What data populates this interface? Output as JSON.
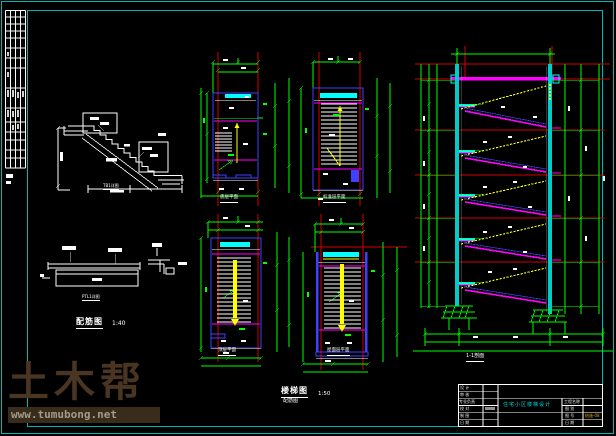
{
  "canvas": {
    "width": 616,
    "height": 436,
    "background": "#000000",
    "frame_color": "#00b7b7"
  },
  "palette": {
    "dimension_green": "#00ff00",
    "grid_red": "#d40000",
    "wall_cyan": "#00ffff",
    "beam_magenta": "#ff00ff",
    "rebar_yellow": "#ffff00",
    "slab_blue": "#4040ff",
    "line_white": "#ffffff"
  },
  "watermark": {
    "brand": "土木帮",
    "url": "www.tumubong.net",
    "brand_color": "#4a3522",
    "bar_color": "#3a2c1b",
    "url_color": "#a29a8b"
  },
  "captions": {
    "stair_detail": "TB1详图",
    "beam_detail": "PTL1详图",
    "left_figure_title": "配筋图",
    "left_figure_scale": "1:40",
    "plans": [
      {
        "label": "底层平面"
      },
      {
        "label": "标准层平面"
      },
      {
        "label": "顶层平面"
      },
      {
        "label": "屋面层平面"
      }
    ],
    "center_figure_title": "楼梯图",
    "center_figure_subtitle": "配筋图",
    "center_figure_scale": "1:50",
    "section_title": "1-1剖面"
  },
  "titleblock": {
    "left_labels": [
      "设 计",
      "审 核",
      "专业负责",
      "校 对",
      "制 图",
      "日 期"
    ],
    "right_labels": [
      "工程名称",
      "图 别",
      "图 号",
      "日 期"
    ],
    "project_title": "住宅小区楼梯设计",
    "drawing_number": "结施-08",
    "project_color": "#00d8d8",
    "number_color": "#d8a020"
  }
}
